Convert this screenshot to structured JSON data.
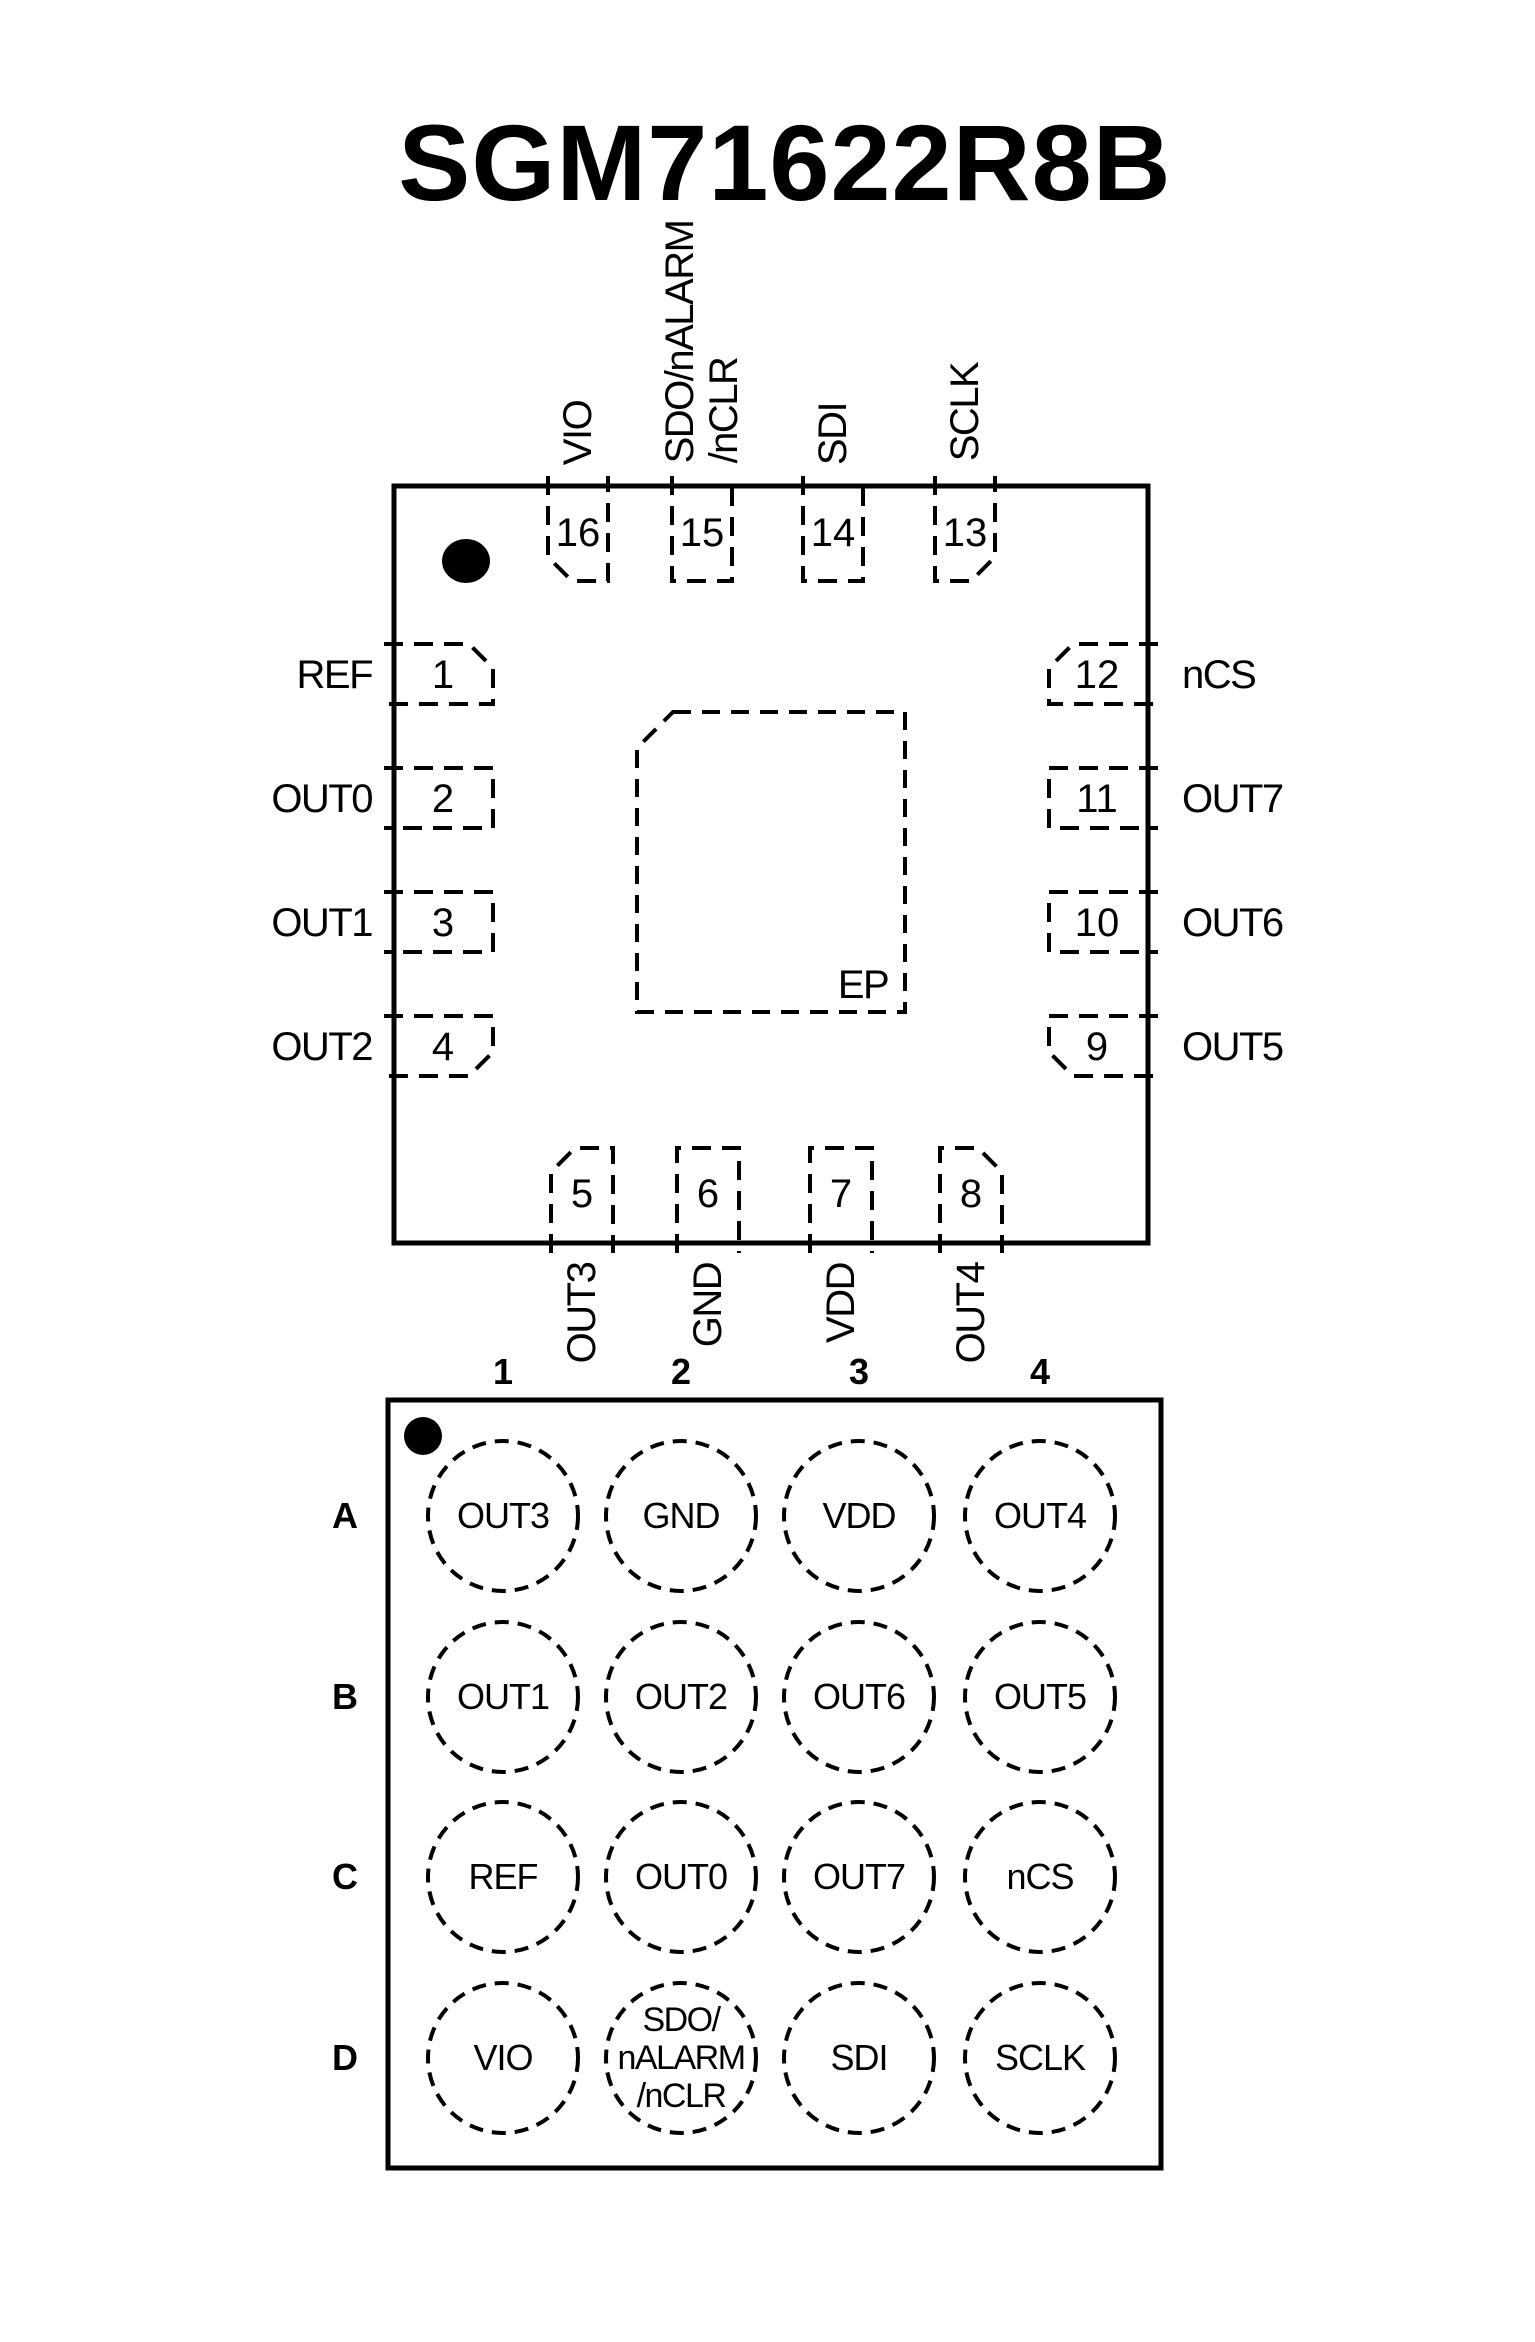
{
  "title": "SGM71622R8B",
  "qfn": {
    "ep_label": "EP",
    "top": [
      {
        "num": "16",
        "sig": "VIO"
      },
      {
        "num": "15",
        "sig": "SDO/nALARM\n/nCLR"
      },
      {
        "num": "14",
        "sig": "SDI"
      },
      {
        "num": "13",
        "sig": "SCLK"
      }
    ],
    "left": [
      {
        "num": "1",
        "sig": "REF"
      },
      {
        "num": "2",
        "sig": "OUT0"
      },
      {
        "num": "3",
        "sig": "OUT1"
      },
      {
        "num": "4",
        "sig": "OUT2"
      }
    ],
    "right": [
      {
        "num": "12",
        "sig": "nCS"
      },
      {
        "num": "11",
        "sig": "OUT7"
      },
      {
        "num": "10",
        "sig": "OUT6"
      },
      {
        "num": "9",
        "sig": "OUT5"
      }
    ],
    "bottom": [
      {
        "num": "5",
        "sig": "OUT3"
      },
      {
        "num": "6",
        "sig": "GND"
      },
      {
        "num": "7",
        "sig": "VDD"
      },
      {
        "num": "8",
        "sig": "OUT4"
      }
    ]
  },
  "bga": {
    "col_headers": [
      "1",
      "2",
      "3",
      "4"
    ],
    "row_headers": [
      "A",
      "B",
      "C",
      "D"
    ],
    "balls": [
      [
        "OUT3",
        "GND",
        "VDD",
        "OUT4"
      ],
      [
        "OUT1",
        "OUT2",
        "OUT6",
        "OUT5"
      ],
      [
        "REF",
        "OUT0",
        "OUT7",
        "nCS"
      ],
      [
        "VIO",
        "SDO/\nnALARM\n/nCLR",
        "SDI",
        "SCLK"
      ]
    ]
  },
  "colors": {
    "ink": "#000000",
    "background": "#ffffff"
  }
}
